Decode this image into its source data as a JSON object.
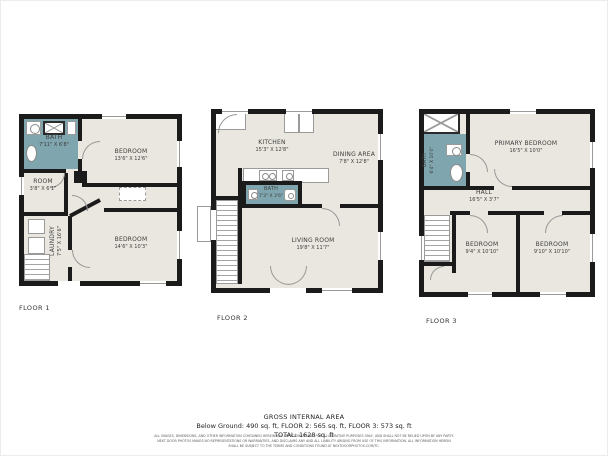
{
  "floors": [
    {
      "label": "FLOOR 1",
      "rooms": {
        "bath": {
          "name": "BATH",
          "dims": "7'11\" X 6'8\""
        },
        "bedroom1": {
          "name": "BEDROOM",
          "dims": "13'6\" X 12'6\""
        },
        "room": {
          "name": "ROOM",
          "dims": "3'8\" X 6'1\""
        },
        "laundry": {
          "name": "LAUNDRY",
          "dims": "7'5\" X 16'6\""
        },
        "bedroom2": {
          "name": "BEDROOM",
          "dims": "14'6\" X 10'3\""
        }
      }
    },
    {
      "label": "FLOOR 2",
      "rooms": {
        "kitchen": {
          "name": "KITCHEN",
          "dims": "15'3\" X 12'8\""
        },
        "dining": {
          "name": "DINING AREA",
          "dims": "7'8\" X 12'8\""
        },
        "bath": {
          "name": "BATH",
          "dims": "7'3\" X 3'6\""
        },
        "living": {
          "name": "LIVING ROOM",
          "dims": "19'8\" X 11'7\""
        }
      }
    },
    {
      "label": "FLOOR 3",
      "rooms": {
        "bath": {
          "name": "BATH",
          "dims": "6'4\" X 10'0\""
        },
        "primary": {
          "name": "PRIMARY BEDROOM",
          "dims": "16'5\" X 10'0\""
        },
        "hall": {
          "name": "HALL",
          "dims": "16'5\" X 3'7\""
        },
        "bedroom1": {
          "name": "BEDROOM",
          "dims": "9'4\" X 10'10\""
        },
        "bedroom2": {
          "name": "BEDROOM",
          "dims": "9'10\" X 10'10\""
        }
      }
    }
  ],
  "summary": {
    "title": "GROSS INTERNAL AREA",
    "line1": "Below Ground: 490 sq. ft, FLOOR 2: 565 sq. ft, FLOOR 3: 573 sq. ft",
    "line2": "TOTAL: 1628 sq. ft",
    "disclaimer1": "ALL IMAGES, DIMENSIONS, AND OTHER INFORMATION CONTAINED HEREIN ARE APPROXIMATE AND FOR ILLUSTRATIVE PURPOSES ONLY, AND SHALL NOT BE RELIED UPON BY ANY PARTY.",
    "disclaimer2": "NEXT DOOR PHOTOS MAKES NO REPRESENTATIONS OR WARRANTIES, AND DISCLAIMS ANY AND ALL LIABILITY ARISING FROM USE OF THIS INFORMATION. ALL INFORMATION HEREIN",
    "disclaimer3": "SHALL BE SUBJECT TO THE TERMS AND CONDITIONS FOUND AT NEXTDOORPHOTOS.COM/TC."
  },
  "icons": [
    "sink-icon",
    "shower-icon",
    "toilet-icon",
    "bathtub-icon",
    "stove-icon",
    "washer-icon",
    "dryer-icon",
    "fridge-icon",
    "stairs-icon",
    "door-arc",
    "window"
  ],
  "colors": {
    "wall": "#1b1b1b",
    "floor_fill": "#e9e7df",
    "bath_fill": "#7fa5ae",
    "background": "#ffffff"
  }
}
